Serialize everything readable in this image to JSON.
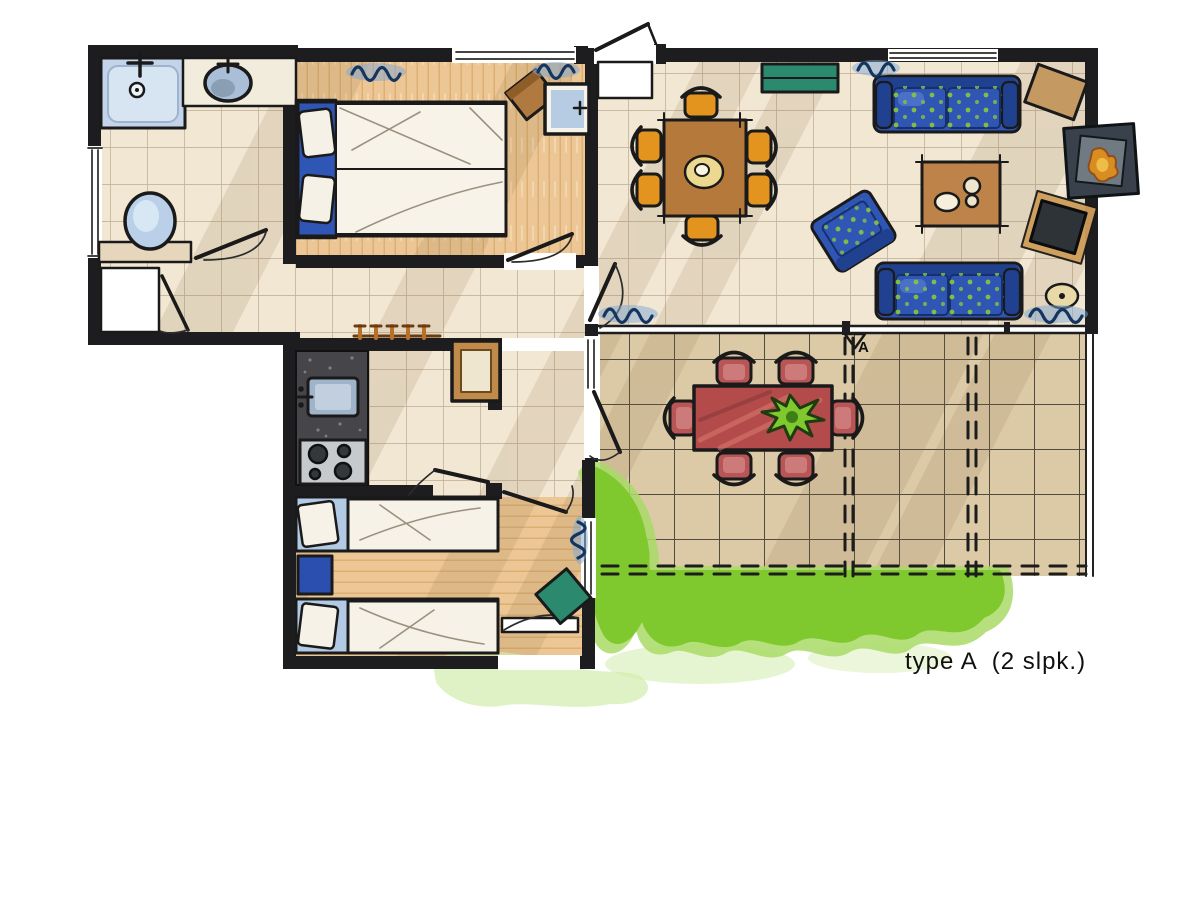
{
  "plan": {
    "label": "type A  (2 slpk.)",
    "section_marker": "A"
  },
  "colors": {
    "ink": "#1a1a1a",
    "wall": "#1d1d1f",
    "tile": "#f1e7d3",
    "tile_line": "#a8937a",
    "wood": "#ecc795",
    "wood_line": "#d8a96c",
    "terrace": "#dcc9a6",
    "shadow": "#8a6f45",
    "blue": "#2f55b5",
    "blue_dark": "#20418f",
    "dot_green": "#86c33e",
    "light_blue": "#afc8e4",
    "curtain_blue": "#7fa8d4",
    "orange": "#e2941f",
    "table_brown": "#b5793c",
    "coffee_brown": "#bd8348",
    "teal": "#2b8a6e",
    "red_table": "#b34b4b",
    "red_chair": "#b85656",
    "red_chair_light": "#cf8080",
    "grass": "#7fc92e",
    "grass_mid": "#a9db66",
    "grass_light": "#d2ecac",
    "counter_dark": "#45454a",
    "steel": "#c6cacd",
    "plate": "#ecd98f",
    "fire": "#d78d1f",
    "fireplace": "#39424c",
    "fireplace_inner": "#707a83",
    "tv": "#2e3338",
    "mat": "#cf9d58",
    "rug": "#ead9a8",
    "white": "#ffffff"
  },
  "rooms": [
    {
      "name": "bathroom",
      "furniture": [
        "shower",
        "washbasin",
        "toilet"
      ]
    },
    {
      "name": "bedroom-1",
      "furniture": [
        "double-bed",
        "chair",
        "washstand"
      ]
    },
    {
      "name": "hallway",
      "furniture": [
        "storage-closet",
        "coat-rack",
        "wall-table"
      ]
    },
    {
      "name": "kitchen",
      "furniture": [
        "counter",
        "sink",
        "stove"
      ]
    },
    {
      "name": "living-dining-room",
      "furniture": [
        "dining-table",
        "dining-chairs-x6",
        "sideboard",
        "sofa-top",
        "sofa-bottom",
        "armchair",
        "coffee-table",
        "side-table",
        "tv",
        "fireplace",
        "rug"
      ]
    },
    {
      "name": "terrace",
      "furniture": [
        "garden-table",
        "garden-chairs-x6",
        "plant"
      ]
    },
    {
      "name": "bedroom-2",
      "furniture": [
        "single-bed-x2",
        "nightstand",
        "chair"
      ]
    },
    {
      "name": "garden",
      "furniture": []
    }
  ]
}
